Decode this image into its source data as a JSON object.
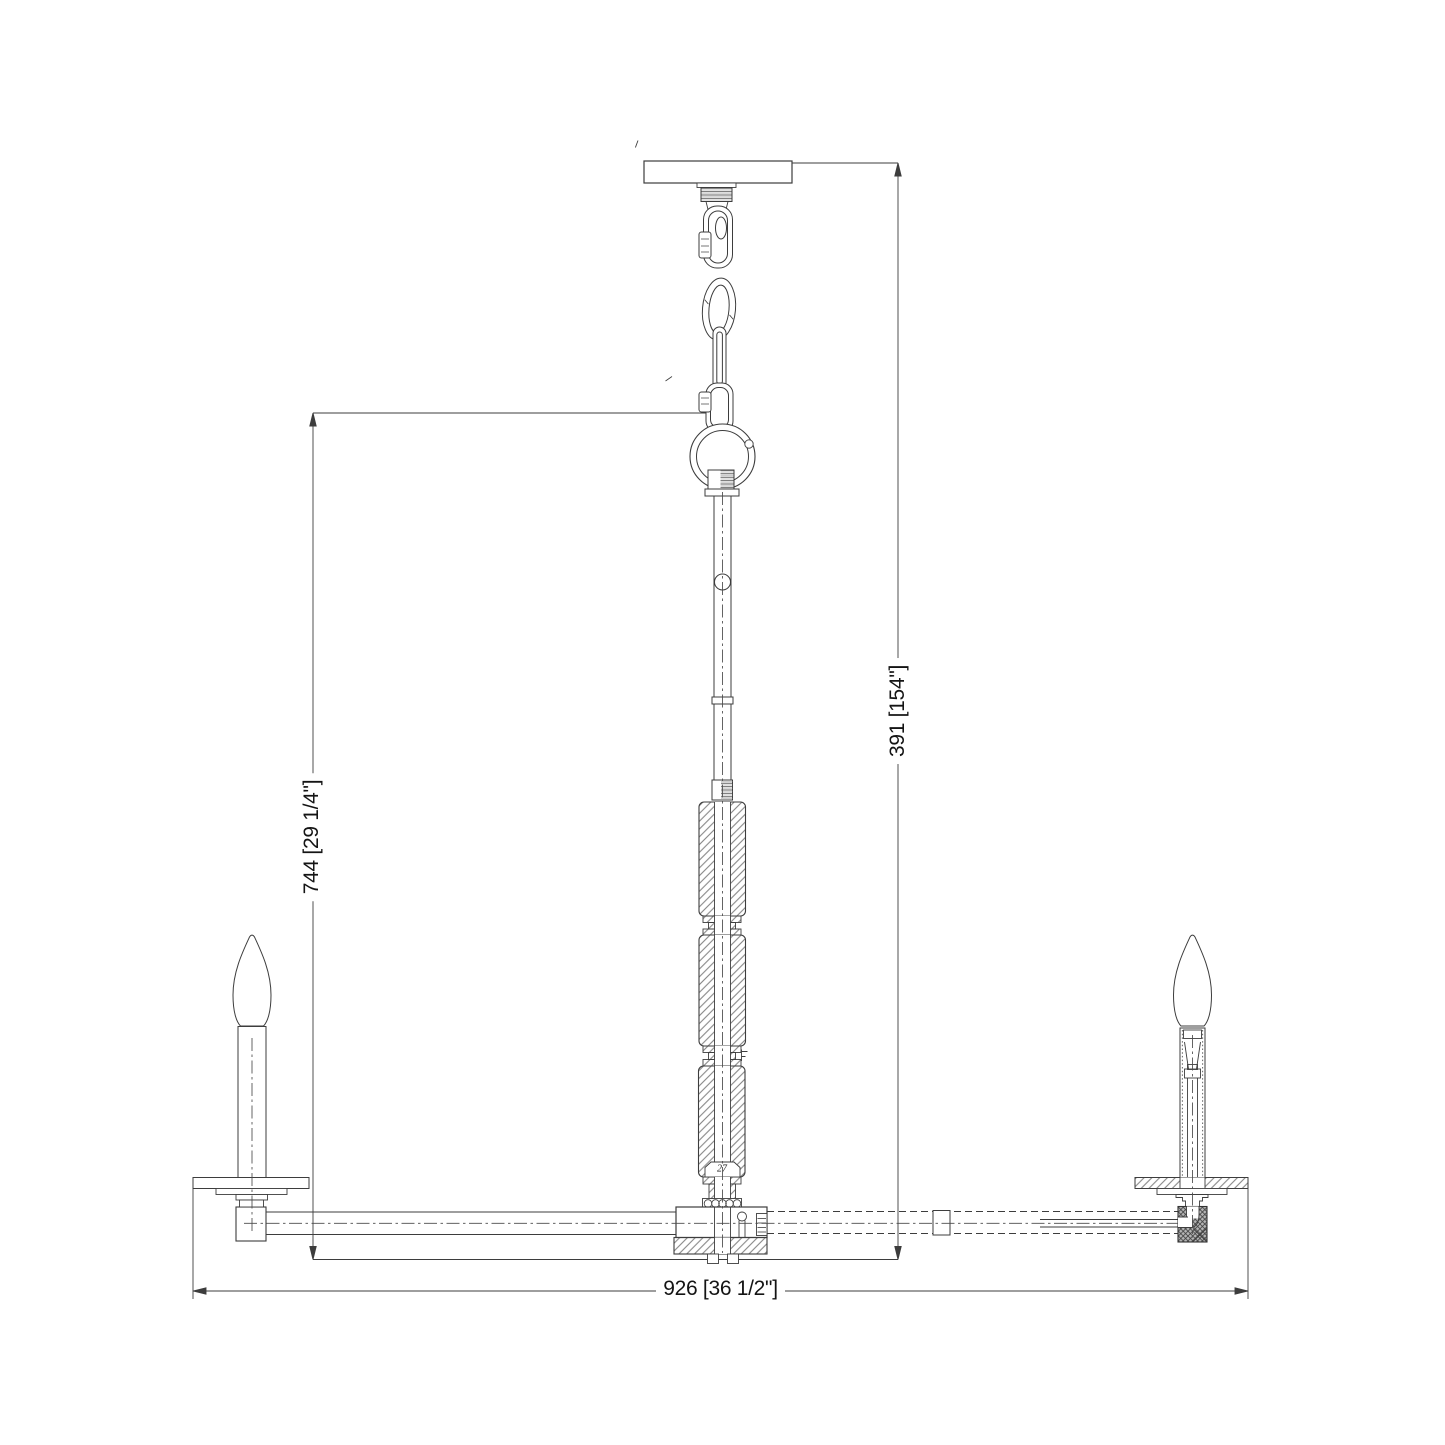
{
  "drawing": {
    "dimension_width": "926 [36 1/2\"]",
    "dimension_height_body": "744 [29 1/4\"]",
    "dimension_height_overall": "391 [154\"]",
    "stem_section_label": "27",
    "colors": {
      "background": "#ffffff",
      "line": "#3d3d3d",
      "text": "#141414"
    }
  }
}
